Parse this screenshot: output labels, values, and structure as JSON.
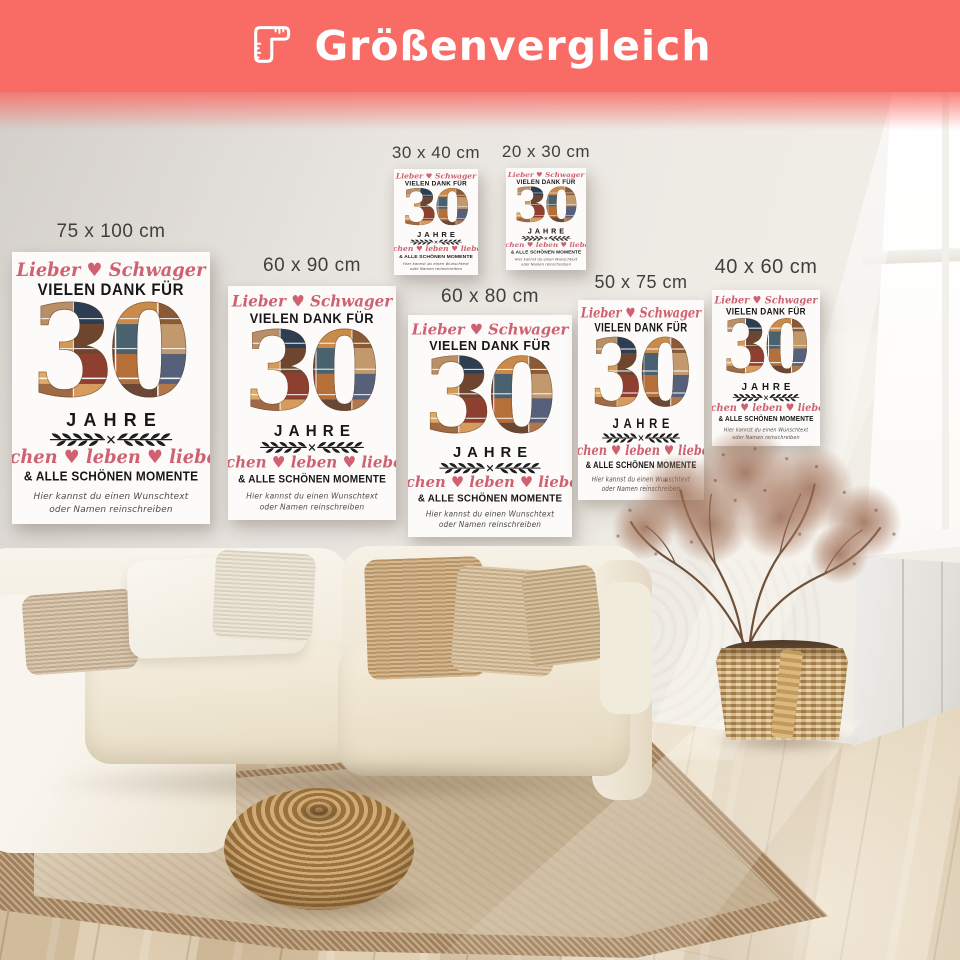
{
  "banner": {
    "title": "Größenvergleich",
    "icon": "ruler-icon",
    "bg_color": "#f96b65",
    "text_color": "#ffffff"
  },
  "poster_design": {
    "dedication_script": "Lieber ♥ Schwager",
    "thanks_line": "VIELEN DANK FÜR",
    "big_number": "30",
    "years_line": "JAHRE",
    "divider_icon": "laurel-divider-icon",
    "motto_script": "lachen ♥ leben ♥ lieben",
    "moments_line": "& ALLE SCHÖNEN MOMENTE",
    "custom_hint_line1": "Hier kannst du einen Wunschtext",
    "custom_hint_line2": "oder Namen reinschreiben",
    "script_color": "#cf6170",
    "text_color": "#171717",
    "collage_theme": "photo-collage-number"
  },
  "posters": [
    {
      "label": "75 x 100 cm"
    },
    {
      "label": "60 x 90 cm"
    },
    {
      "label": "30 x 40 cm"
    },
    {
      "label": "20 x 30 cm"
    },
    {
      "label": "60 x 80 cm"
    },
    {
      "label": "50 x 75 cm"
    },
    {
      "label": "40 x 60 cm"
    }
  ],
  "scene": {
    "wall_color": "#e9e5e0",
    "floor_color": "#d8c6a9",
    "rug_border_color": "#ab8a64",
    "rug_field_color": "#d8c6a8",
    "sofa_color": "#f6f1e6",
    "objects": [
      "sofa",
      "pillows",
      "rattan-pouf",
      "area-rug",
      "wood-floor",
      "dried-plant",
      "wicker-basket",
      "window",
      "radiator-panel"
    ]
  }
}
